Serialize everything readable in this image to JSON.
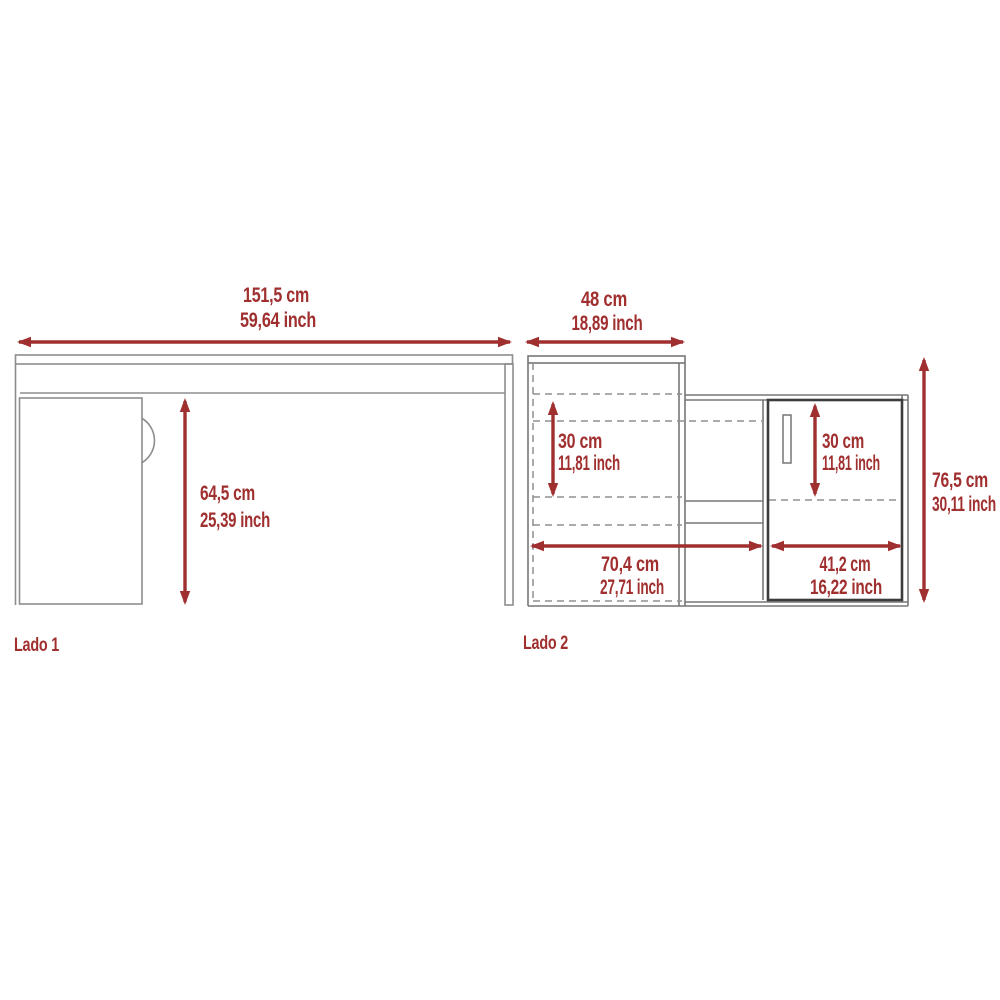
{
  "colors": {
    "accent": "#A02F2F",
    "line_light": "#8D8D8D",
    "line_mid": "#777777",
    "line_dashed": "#8F8F8F",
    "door": "#3C3C3C",
    "background": "#FFFFFF"
  },
  "side1": {
    "label": "Lado 1",
    "width_cm": "151,5 cm",
    "width_inch": "59,64 inch",
    "height_cm": "64,5 cm",
    "height_inch": "25,39 inch"
  },
  "side2": {
    "label": "Lado 2",
    "top_width_cm": "48 cm",
    "top_width_inch": "18,89 inch",
    "left_shelf_height_cm": "30 cm",
    "left_shelf_height_inch": "11,81 inch",
    "right_shelf_height_cm": "30 cm",
    "right_shelf_height_inch": "11,81 inch",
    "bottom_left_width_cm": "70,4 cm",
    "bottom_left_width_inch": "27,71 inch",
    "bottom_right_width_cm": "41,2 cm",
    "bottom_right_width_inch": "16,22 inch",
    "height_cm": "76,5 cm",
    "height_inch": "30,11 inch"
  }
}
